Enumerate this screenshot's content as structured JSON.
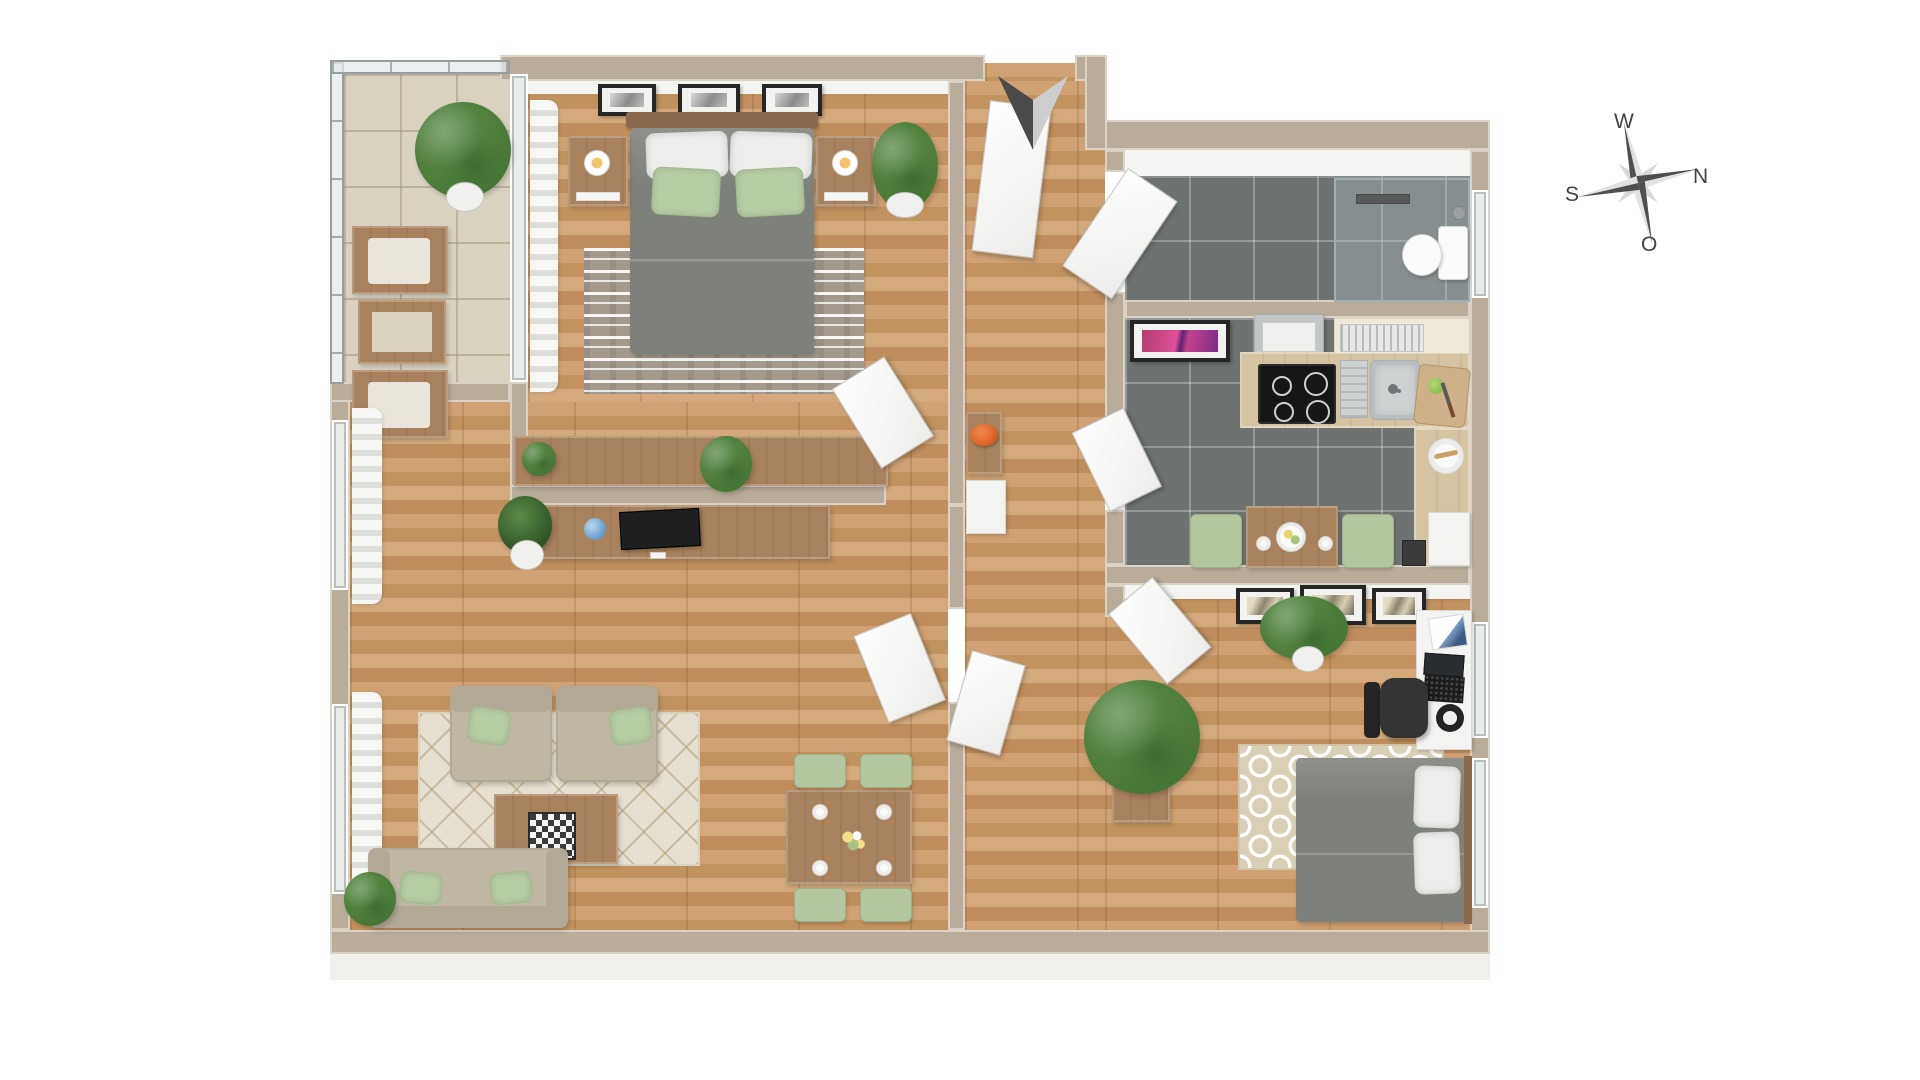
{
  "compass": {
    "up_label": "W",
    "right_label": "N",
    "left_label": "S",
    "down_label": "O"
  },
  "entrance_marker": "arrow-icon",
  "colors": {
    "background": "#ffffff",
    "outer_wall": "#b9ac9a",
    "wood_floor": "#c79a6b",
    "dark_tile": "#6e7270",
    "balcony_tile": "#d9d2c1",
    "rug_beige": "#e6e0d2",
    "sofa_beige": "#c0b7a5",
    "cushion_green": "#b7cda6",
    "chair_green": "#b3c6a0",
    "bed_gray": "#7e807b",
    "counter_cream": "#efe9da",
    "wood_furniture": "#a8825c",
    "accent_orange": "#dd6429",
    "art_pink": "#d14a8e",
    "compass_text": "#424242"
  },
  "rooms": [
    {
      "id": "balcony",
      "features": [
        "glass-railing",
        "palm-plant",
        "two-wood-chairs",
        "side-table",
        "tile-floor"
      ]
    },
    {
      "id": "bedroom",
      "features": [
        "double-bed",
        "two-nightstands-with-candles",
        "three-wall-frames",
        "striped-rug",
        "sideboard",
        "curtain",
        "potted-plants"
      ]
    },
    {
      "id": "hallway",
      "features": [
        "entry-door",
        "console-with-orange-bowl",
        "white-cabinet",
        "storage-door"
      ]
    },
    {
      "id": "bathroom",
      "features": [
        "walk-in-shower",
        "toilet",
        "dark-tile-floor"
      ]
    },
    {
      "id": "kitchen",
      "features": [
        "l-shaped-counter",
        "range-hood",
        "cooktop",
        "sink",
        "dish-rack",
        "cutting-board",
        "pink-wall-art",
        "table-for-two",
        "green-chairs",
        "fridge"
      ]
    },
    {
      "id": "office-bedroom",
      "features": [
        "desk-with-laptop",
        "office-chair",
        "desk-lamp",
        "three-sail-pictures",
        "ogee-rug",
        "single-bed",
        "planter",
        "plants"
      ]
    },
    {
      "id": "living-room",
      "features": [
        "two-armchairs",
        "sofa",
        "coffee-table-with-chessboard",
        "diamond-rug",
        "tv-lowboard",
        "dining-table-four-chairs",
        "window-curtains",
        "plants"
      ]
    }
  ]
}
